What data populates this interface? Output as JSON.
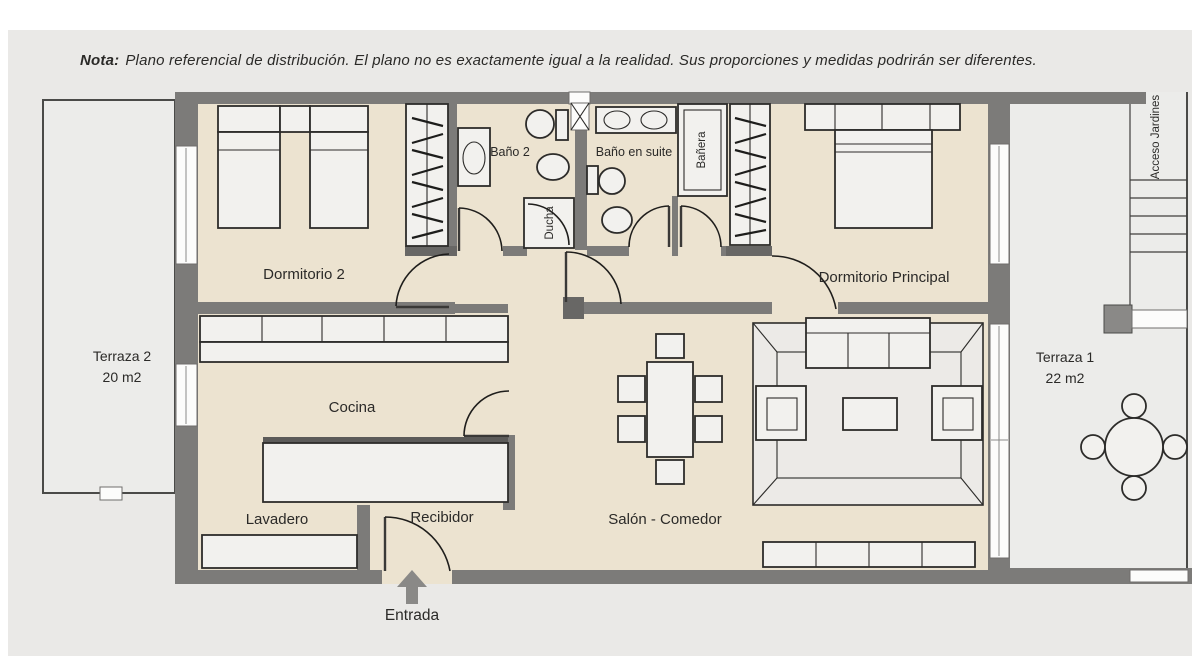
{
  "note": {
    "label": "Nota:",
    "text": "Plano referencial de distribución. El plano no es exactamente igual a la realidad. Sus proporciones y medidas podrirán ser diferentes."
  },
  "labels": {
    "dormitorio2": "Dormitorio 2",
    "bano2": "Baño 2",
    "ducha": "Ducha",
    "bano_en_suite": "Baño en suite",
    "banera": "Bañera",
    "dormitorio_principal": "Dormitorio Principal",
    "cocina": "Cocina",
    "lavadero": "Lavadero",
    "recibidor": "Recibidor",
    "salon_comedor": "Salón - Comedor",
    "entrada": "Entrada",
    "acceso_jardines": "Acceso Jardines",
    "terraza1_name": "Terraza 1",
    "terraza1_area": "22 m2",
    "terraza2_name": "Terraza 2",
    "terraza2_area": "20 m2"
  },
  "colors": {
    "panel": "#eae9e7",
    "wall": "#7c7b79",
    "wall_dark": "#686765",
    "floor": "#ece3d0",
    "terrace": "#ececea",
    "furniture": "#f2f1ee",
    "outline": "#2d2c2a",
    "window": "#fcfcfb",
    "text": "#2b2a28",
    "arrow": "#8a8987"
  }
}
